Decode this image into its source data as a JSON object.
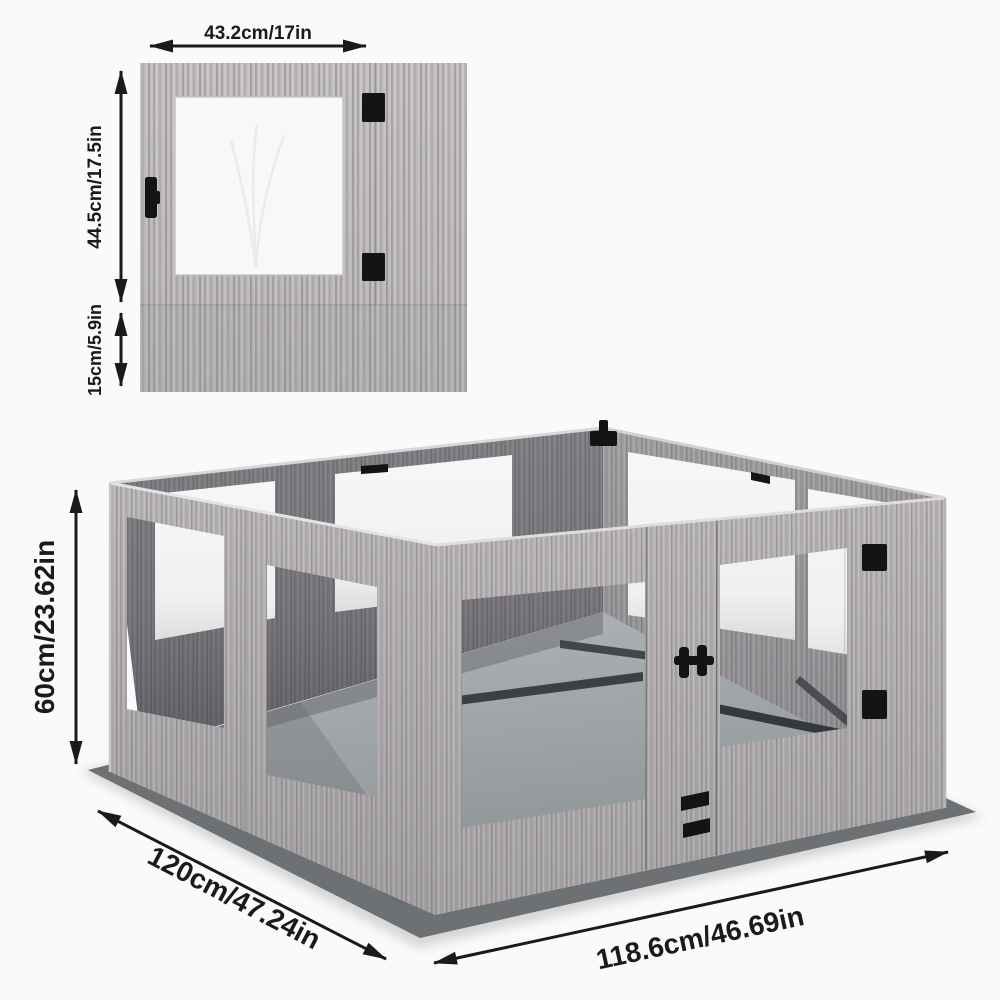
{
  "page": {
    "title": "Playpen panel and assembled dimensions diagram",
    "background": "#fafafa"
  },
  "panel_diagram": {
    "description": "single fence panel, front view",
    "width_label": "43.2cm/17in",
    "panel_height_label": "44.5cm/17.5in",
    "skirt_height_label": "15cm/5.9in",
    "hardware_icons": [
      "panel-hinge-icon",
      "panel-latch-icon"
    ]
  },
  "assembled_diagram": {
    "description": "assembled playpen, isometric view",
    "height_label": "60cm/23.62in",
    "depth_label": "120cm/47.24in",
    "width_label": "118.6cm/46.69in",
    "hardware_icons": [
      "corner-clamp-icon",
      "door-latch-icon",
      "side-hinge-icon",
      "door-connector-icon",
      "rail-slot-icon"
    ]
  },
  "colors": {
    "dimension_text": "#1a1a1a",
    "arrow": "#1a1a1a",
    "wood_light": "#bcb9ba",
    "wood_mid": "#a9a6a8",
    "wood_dark": "#908e92",
    "window_white": "#f4f5f5",
    "floor_gray": "#9aa0a2",
    "mat_dark": "#6e7173",
    "hardware_black": "#141414"
  }
}
